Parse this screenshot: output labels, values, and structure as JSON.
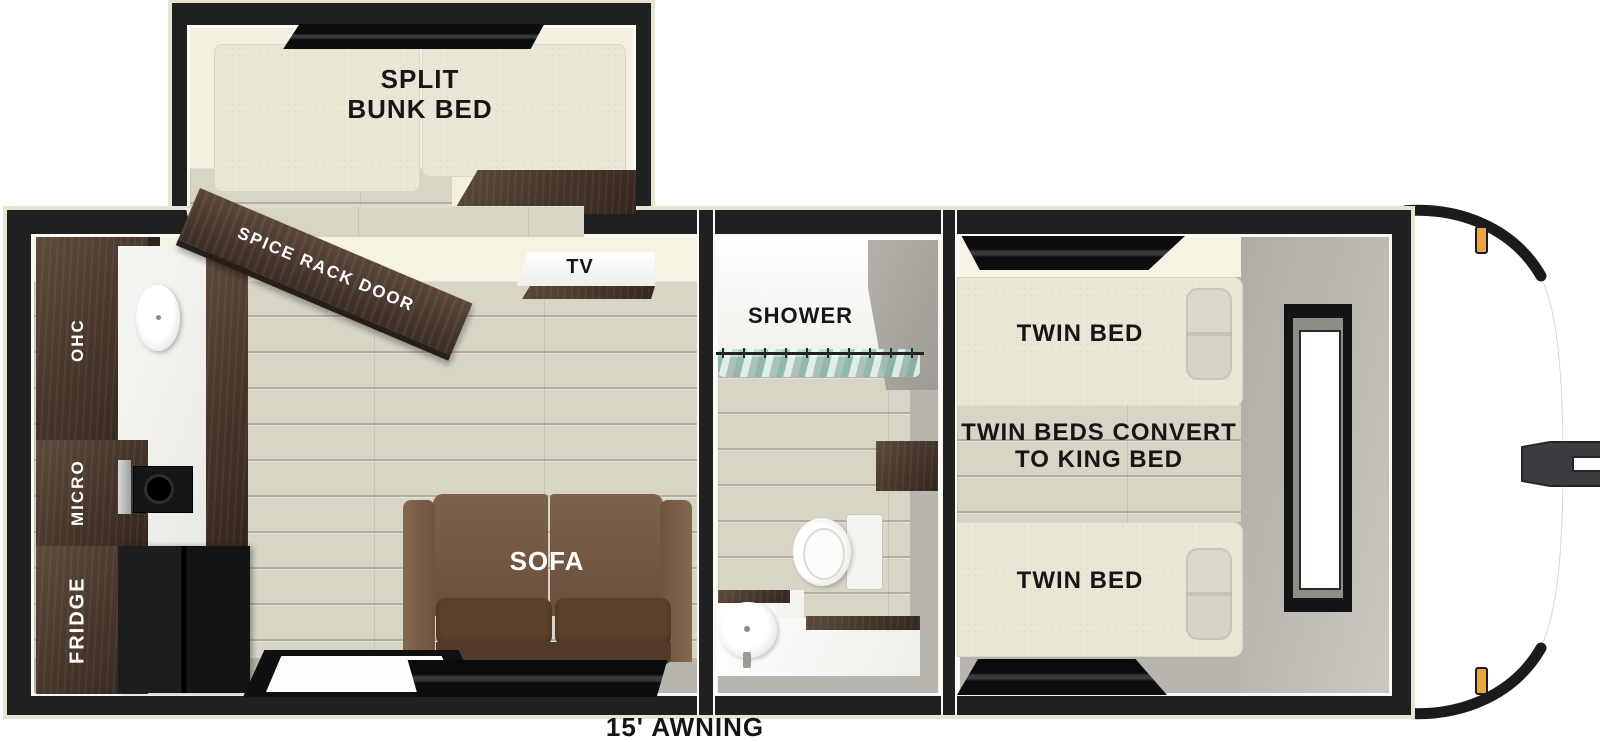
{
  "floorplan": {
    "title": "travel trailer floorplan",
    "awning": "15' AWNING",
    "bunk_room": {
      "bed_line1": "SPLIT",
      "bed_line2": "BUNK BED",
      "door": "SPICE RACK DOOR"
    },
    "kitchen": {
      "ohc": "OHC",
      "micro": "MICRO",
      "fridge": "FRIDGE",
      "tv": "TV"
    },
    "living": {
      "sofa": "SOFA"
    },
    "bath": {
      "shower": "SHOWER"
    },
    "bedroom": {
      "bed_front": "TWIN BED",
      "bed_rear": "TWIN BED",
      "note_line1": "TWIN BEDS CONVERT",
      "note_line2": "TO KING BED"
    },
    "colors": {
      "wall": "#202020",
      "trim": "#e8e3d1",
      "floor": "#d8d4c6",
      "mattress": "#eae7d7",
      "ceiling": "#f6f3e4",
      "dark-wood": "#4a392e",
      "sofa": "#73573f",
      "seat": "#5b4129",
      "gray-wall": "#b7b5ad",
      "curtain": "#9ed0c3",
      "marker-light": "#eda63e",
      "hitch": "#3c3c43",
      "label": "#161616"
    }
  }
}
